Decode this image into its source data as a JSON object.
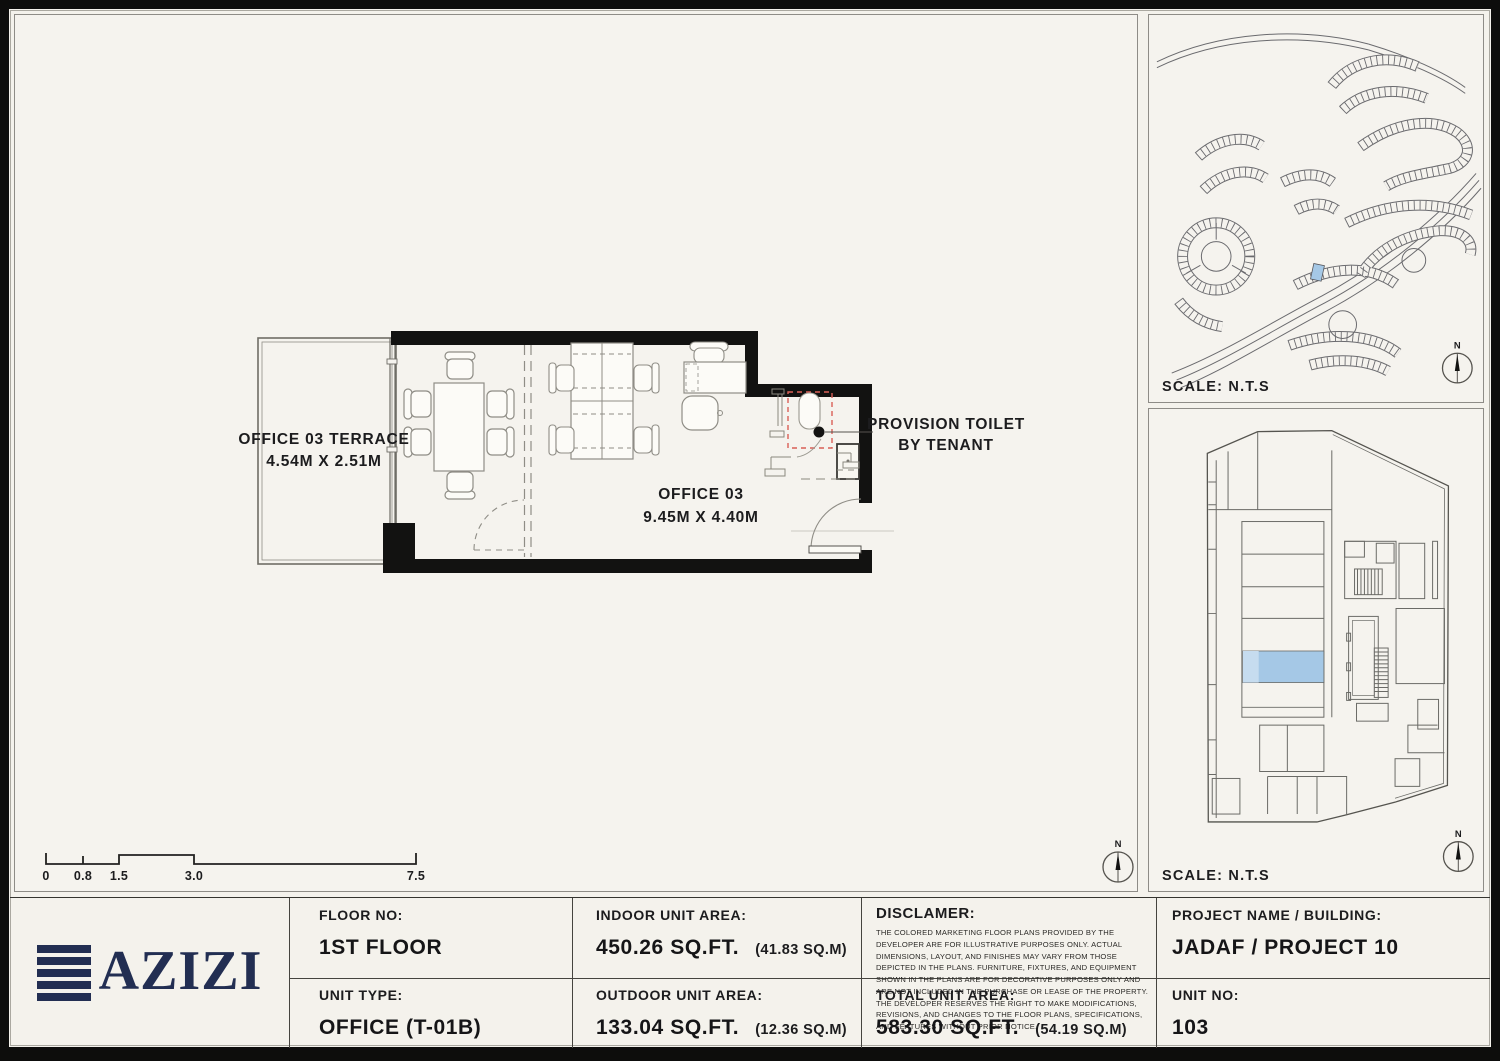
{
  "colors": {
    "navy": "#222e52",
    "highlight": "#a5c8e6",
    "highlight_light": "#c6dcef",
    "provision_red": "#d95f57"
  },
  "plan": {
    "terrace_label": "OFFICE 03 TERRACE",
    "terrace_dims": "4.54M X 2.51M",
    "office_label": "OFFICE 03",
    "office_dims": "9.45M X 4.40M",
    "annotation_line1": "PROVISION TOILET",
    "annotation_line2": "BY TENANT",
    "north": "N",
    "scale_bar": {
      "labels": [
        "0",
        "0.8",
        "1.5",
        "3.0",
        "7.5"
      ]
    }
  },
  "site_map": {
    "scale_label": "SCALE: N.T.S",
    "north": "N"
  },
  "key_plan": {
    "scale_label": "SCALE: N.T.S",
    "north": "N"
  },
  "title_block": {
    "logo_word": "AZIZI",
    "floor_label": "FLOOR NO:",
    "floor_value": "1ST FLOOR",
    "unit_type_label": "UNIT TYPE:",
    "unit_type_value": "OFFICE (T-01B)",
    "indoor_label": "INDOOR UNIT AREA:",
    "indoor_value": "450.26 SQ.FT.",
    "indoor_metric": "(41.83 SQ.M)",
    "outdoor_label": "OUTDOOR UNIT AREA:",
    "outdoor_value": "133.04 SQ.FT.",
    "outdoor_metric": "(12.36  SQ.M)",
    "disclaimer_label": "DISCLAMER:",
    "disclaimer_text": "THE COLORED MARKETING FLOOR PLANS PROVIDED BY THE DEVELOPER ARE FOR ILLUSTRATIVE PURPOSES ONLY. ACTUAL DIMENSIONS, LAYOUT, AND FINISHES MAY VARY FROM THOSE DEPICTED IN THE PLANS. FURNITURE, FIXTURES, AND EQUIPMENT SHOWN IN THE PLANS ARE FOR DECORATIVE PURPOSES ONLY AND ARE NOT INCLUDED IN THE PURCHASE OR LEASE OF THE PROPERTY. THE DEVELOPER RESERVES THE RIGHT TO MAKE MODIFICATIONS, REVISIONS, AND CHANGES TO THE FLOOR PLANS, SPECIFICATIONS, AND FEATURES WITHOUT PRIOR NOTICE.",
    "total_label": "TOTAL UNIT AREA:",
    "total_value": "583.30 SQ.FT.",
    "total_metric": "(54.19 SQ.M)",
    "project_label": "PROJECT NAME / BUILDING:",
    "project_value": "JADAF / PROJECT 10",
    "unit_no_label": "UNIT NO:",
    "unit_no_value": "103"
  }
}
